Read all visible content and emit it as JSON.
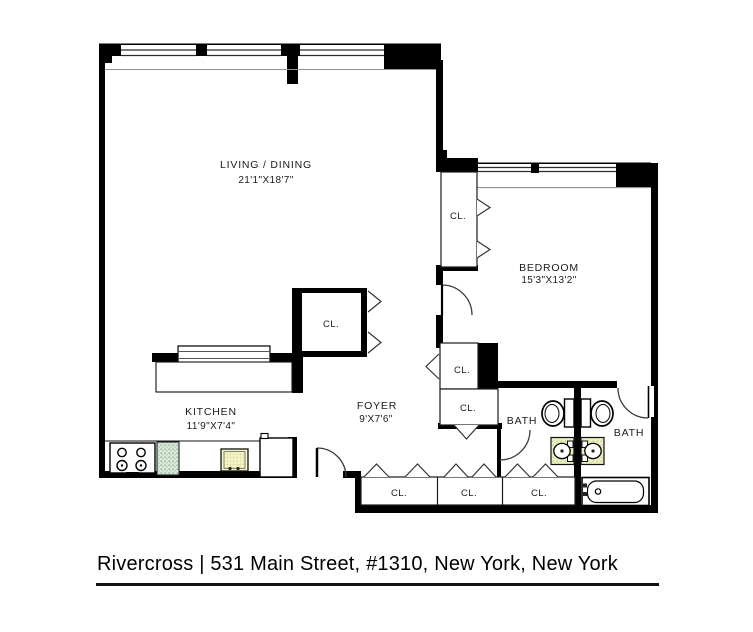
{
  "caption": "Rivercross | 531 Main Street, #1310, New York, New York",
  "rooms": {
    "living": {
      "name": "LIVING / DINING",
      "dims": "21'1\"X18'7\""
    },
    "bedroom": {
      "name": "BEDROOM",
      "dims": "15'3\"X13'2\""
    },
    "kitchen": {
      "name": "KITCHEN",
      "dims": "11'9\"X7'4\""
    },
    "foyer": {
      "name": "FOYER",
      "dims": "9'X7'6\""
    },
    "bath_left": {
      "name": "BATH"
    },
    "bath_right": {
      "name": "BATH"
    }
  },
  "closets": {
    "bedroom_closet": "CL.",
    "living_closet": "CL.",
    "hall_closet_upper": "CL.",
    "hall_closet_lower": "CL.",
    "foyer_closet_1": "CL.",
    "foyer_closet_2": "CL.",
    "foyer_closet_3": "CL."
  },
  "colors": {
    "wall": "#000000",
    "inner_face_line": "#8a8a8a",
    "sink_yellow": "#f6f6c9",
    "appliance_green": "#d7e7d8",
    "vanity_yellow": "#edf0c3"
  }
}
